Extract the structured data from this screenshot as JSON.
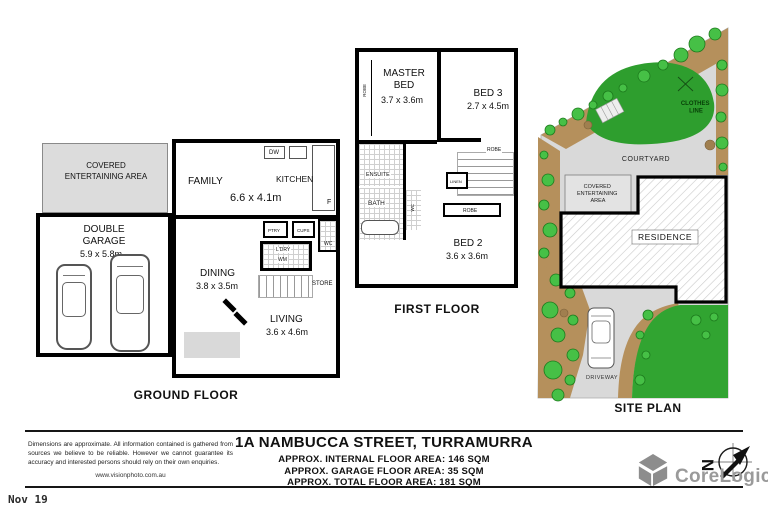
{
  "ground_floor": {
    "label": "GROUND FLOOR",
    "covered_area": "COVERED ENTERTAINING AREA",
    "family": "FAMILY",
    "family_dims": "6.6 x 4.1m",
    "kitchen": "KITCHEN",
    "garage": "DOUBLE GARAGE",
    "garage_dims": "5.9 x 5.8m",
    "dining": "DINING",
    "dining_dims": "3.8 x 3.5m",
    "living": "LIVING",
    "living_dims": "3.6 x 4.6m",
    "fixtures": {
      "dishwasher": "DW",
      "fridge": "F",
      "pantry": "PTRY",
      "cupboard": "CUPS",
      "wc": "WC",
      "laundry": "L'DRY",
      "washing_machine": "WM",
      "store": "STORE"
    }
  },
  "first_floor": {
    "label": "FIRST FLOOR",
    "master": "MASTER BED",
    "master_dims": "3.7 x 3.6m",
    "bed3": "BED 3",
    "bed3_dims": "2.7 x 4.5m",
    "bed2": "BED 2",
    "bed2_dims": "3.6 x 3.6m",
    "ensuite": "ENSUITE",
    "bath": "BATH",
    "wc": "WC",
    "linen": "LINEN",
    "robe_master": "ROBE",
    "robe_bed3": "ROBE",
    "robe_bed2": "ROBE"
  },
  "site_plan": {
    "label": "SITE PLAN",
    "clothes_line_lines": [
      "CLOTHES",
      "LINE"
    ],
    "courtyard": "COURTYARD",
    "covered_lines": [
      "COVERED",
      "ENTERTAINING",
      "AREA"
    ],
    "residence": "RESIDENCE",
    "driveway": "DRIVEWAY"
  },
  "footer": {
    "address": "1A NAMBUCCA STREET, TURRAMURRA",
    "area_lines": [
      "APPROX. INTERNAL FLOOR AREA: 146 SQM",
      "APPROX. GARAGE FLOOR AREA: 35 SQM",
      "APPROX. TOTAL FLOOR AREA: 181 SQM"
    ],
    "disclaimer": "Dimensions are approximate. All information contained is gathered from sources we believe to be reliable. However we cannot guarantee its accuracy and interested persons should rely on their own enquiries.",
    "website": "www.visionphoto.com.au",
    "brand": "CoreLogic",
    "compass_letter": "N",
    "date": "Nov 19"
  },
  "colors": {
    "lawn": "#2e9e2e",
    "lawn_bright": "#31a431",
    "garden_bed": "#b5905c",
    "paving": "#d9d9d9",
    "wall": "#000000",
    "brand_gray": "#9a9a9a"
  }
}
